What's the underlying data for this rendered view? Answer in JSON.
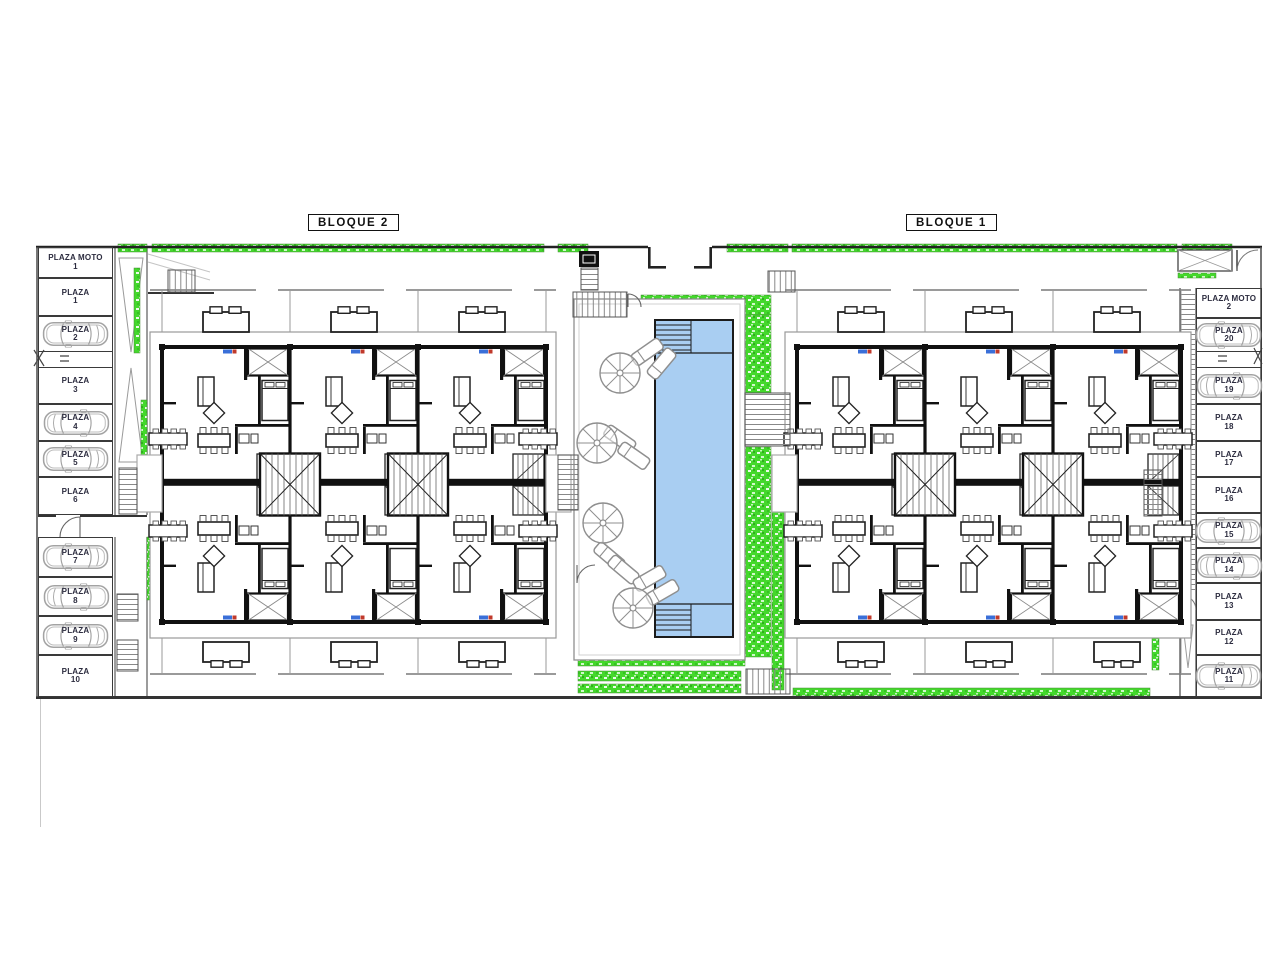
{
  "plan": {
    "block_labels": {
      "bloque2": "BLOQUE 2",
      "bloque1": "BLOQUE 1"
    }
  },
  "parking_left": [
    {
      "name": "PLAZA MOTO",
      "num": "1",
      "car": false
    },
    {
      "name": "PLAZA",
      "num": "1",
      "car": false
    },
    {
      "name": "PLAZA",
      "num": "2",
      "car": true
    },
    {
      "name": "PLAZA",
      "num": "3",
      "car": false
    },
    {
      "name": "PLAZA",
      "num": "4",
      "car": true
    },
    {
      "name": "PLAZA",
      "num": "5",
      "car": true
    },
    {
      "name": "PLAZA",
      "num": "6",
      "car": false
    },
    {
      "name": "PLAZA",
      "num": "7",
      "car": true
    },
    {
      "name": "PLAZA",
      "num": "8",
      "car": true
    },
    {
      "name": "PLAZA",
      "num": "9",
      "car": true
    },
    {
      "name": "PLAZA",
      "num": "10",
      "car": false
    }
  ],
  "parking_right": [
    {
      "name": "PLAZA MOTO",
      "num": "2",
      "car": false
    },
    {
      "name": "PLAZA",
      "num": "20",
      "car": true
    },
    {
      "name": "PLAZA",
      "num": "19",
      "car": true
    },
    {
      "name": "PLAZA",
      "num": "18",
      "car": false
    },
    {
      "name": "PLAZA",
      "num": "17",
      "car": false
    },
    {
      "name": "PLAZA",
      "num": "16",
      "car": false
    },
    {
      "name": "PLAZA",
      "num": "15",
      "car": true
    },
    {
      "name": "PLAZA",
      "num": "14",
      "car": true
    },
    {
      "name": "PLAZA",
      "num": "13",
      "car": false
    },
    {
      "name": "PLAZA",
      "num": "12",
      "car": false
    },
    {
      "name": "PLAZA",
      "num": "11",
      "car": true
    }
  ],
  "colors": {
    "grass": "#44d82c",
    "pool_water": "#a9cef2",
    "wall": "#111111"
  }
}
